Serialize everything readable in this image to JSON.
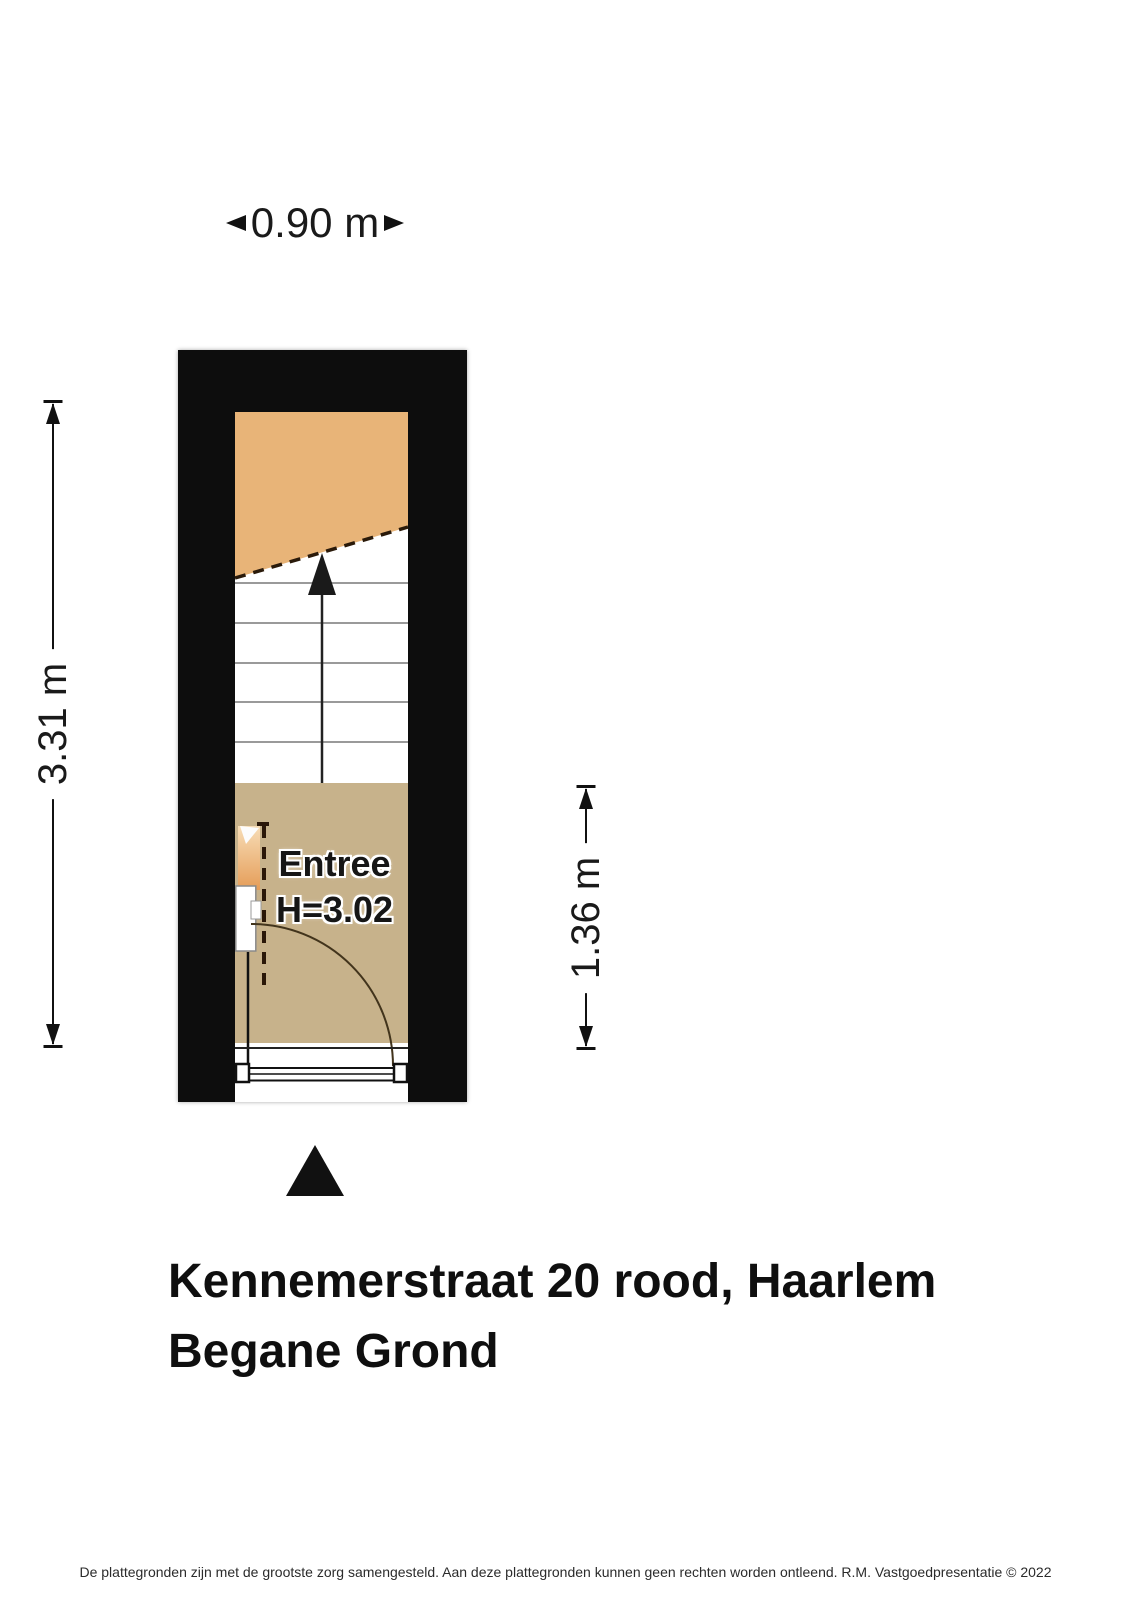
{
  "dimensions": {
    "width_top": "0.90 m",
    "height_left": "3.31 m",
    "height_right": "1.36 m"
  },
  "plan": {
    "room": {
      "name": "Entree",
      "ceiling_height": "H=3.02"
    },
    "colors": {
      "wall": "#0d0d0d",
      "landing": "#e8b478",
      "floor": "#c7b28b",
      "stairline": "#9a9a9a"
    }
  },
  "title": {
    "line1": "Kennemerstraat 20 rood, Haarlem",
    "line2": "Begane Grond"
  },
  "footer": {
    "text": "De plattegronden zijn met de grootste zorg samengesteld. Aan deze plattegronden kunnen geen rechten worden ontleend. R.M. Vastgoedpresentatie © 2022"
  }
}
